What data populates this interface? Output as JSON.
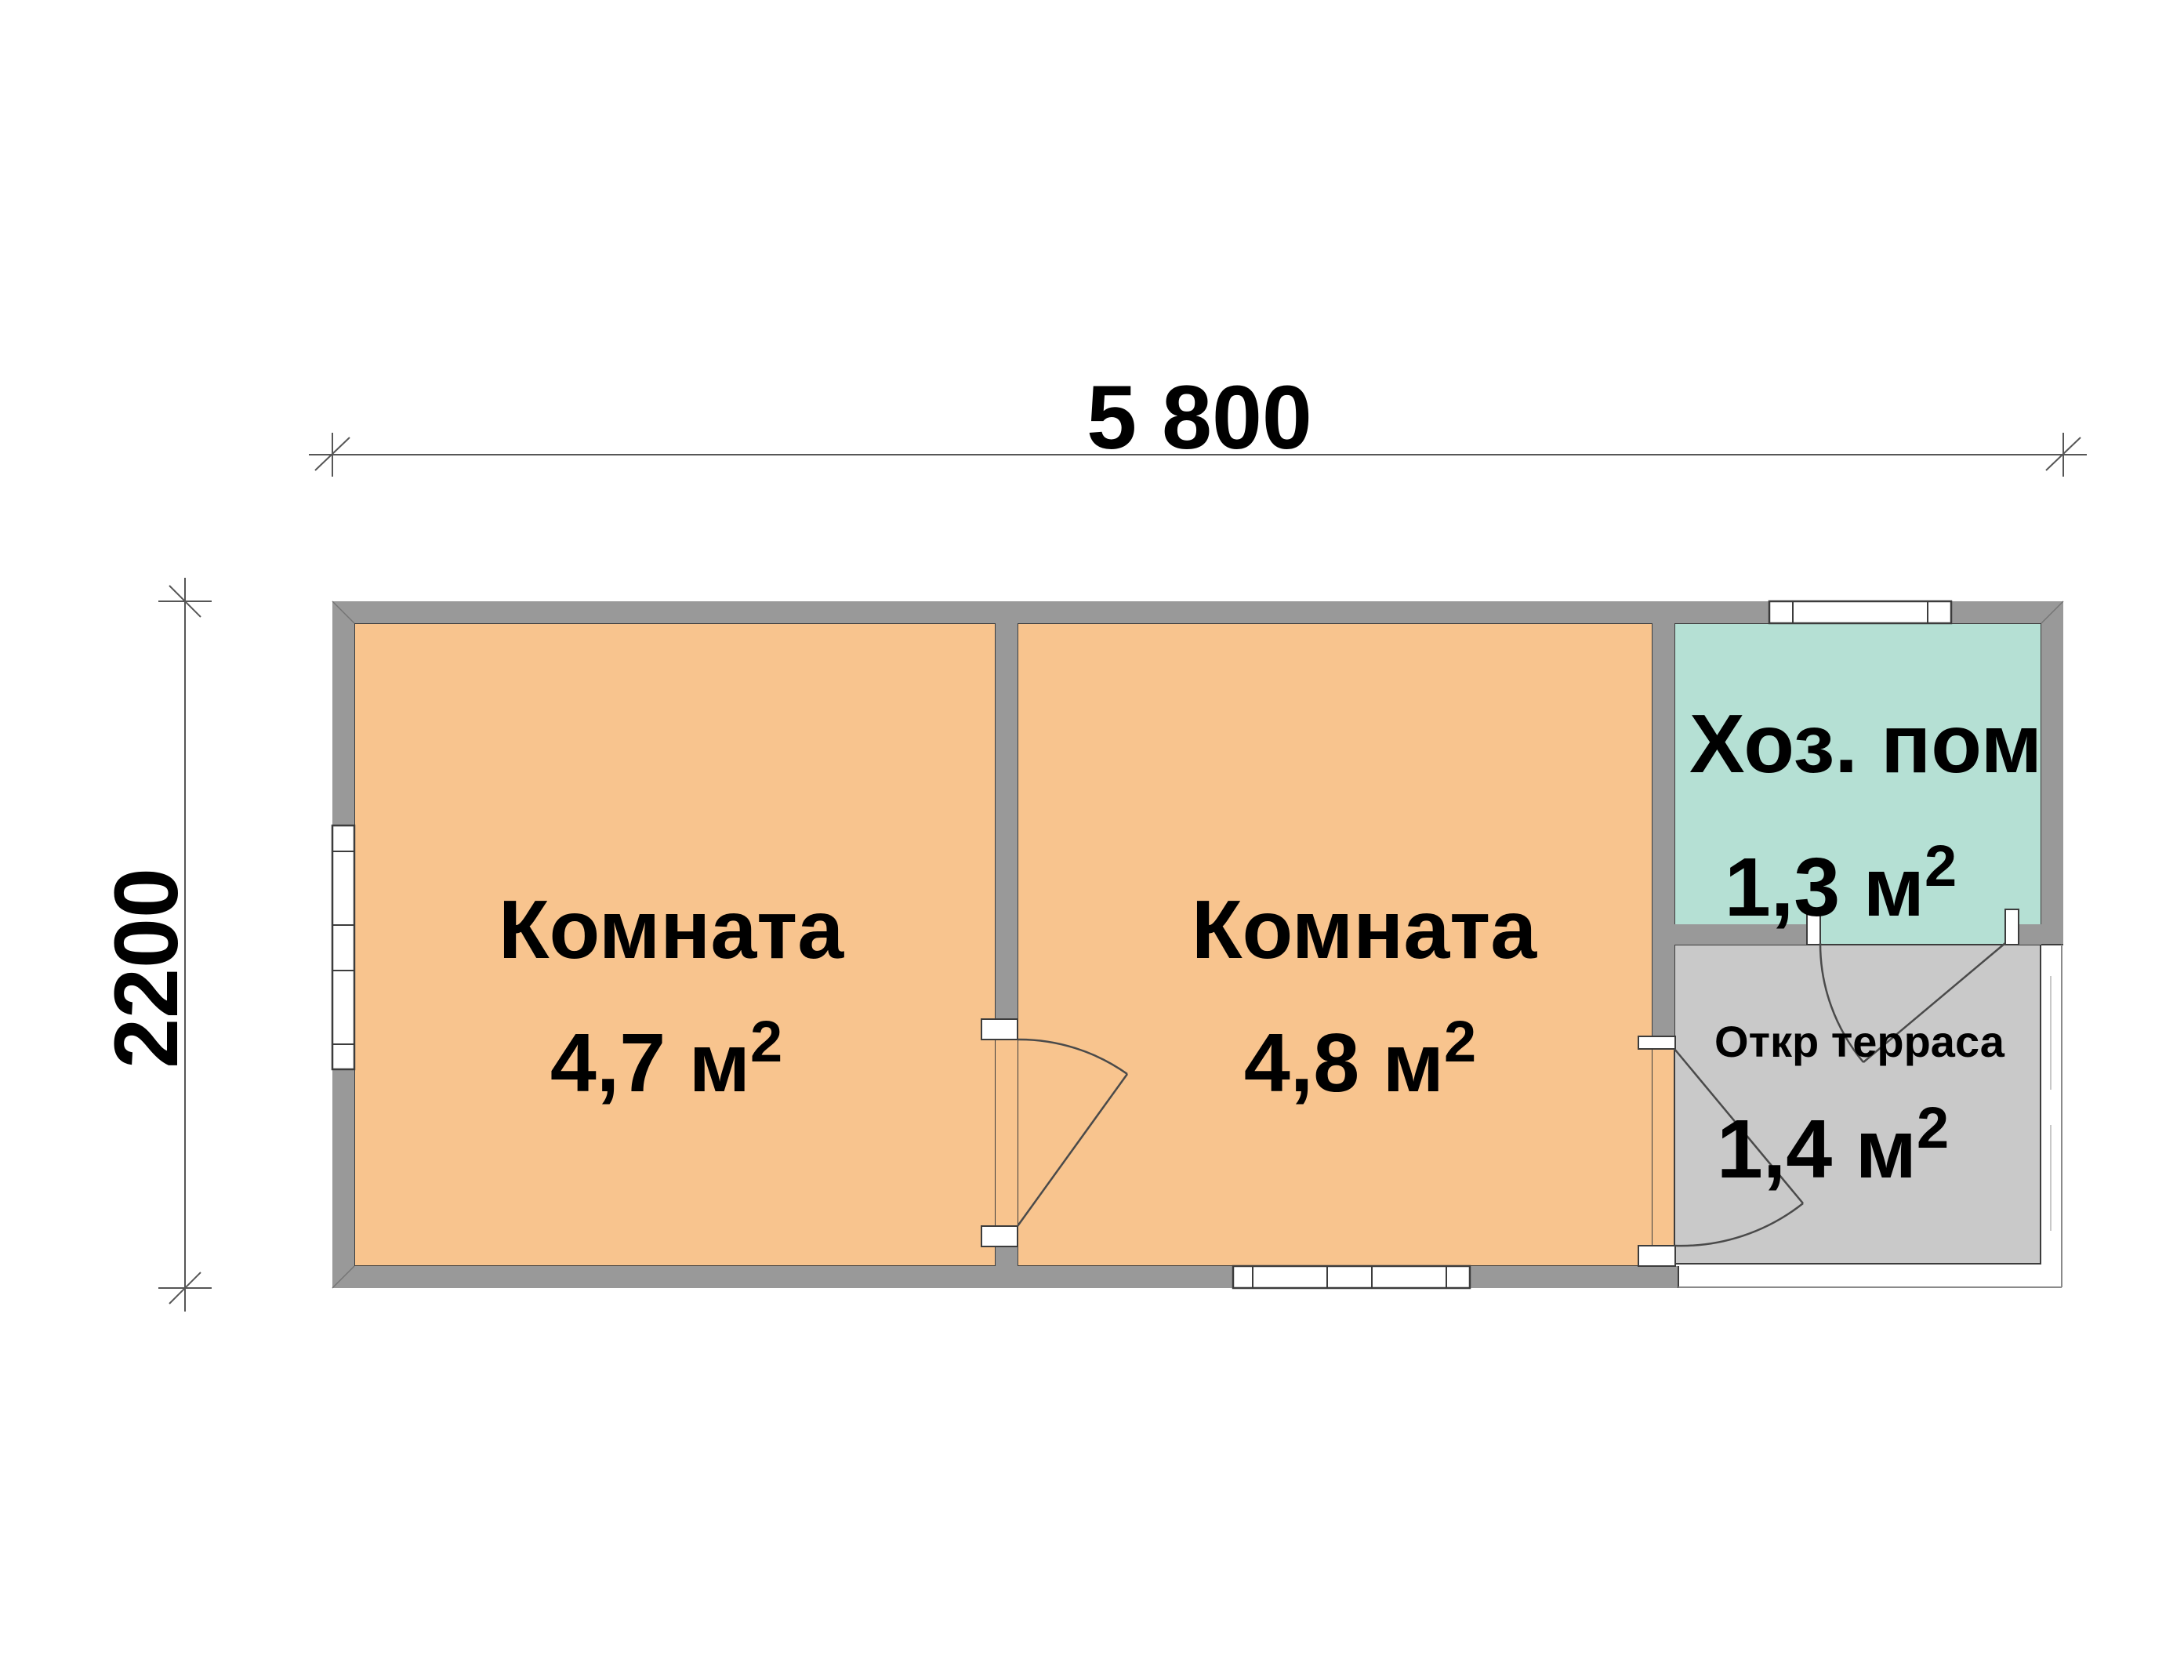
{
  "plan": {
    "dimensions": {
      "width_label": "5 800",
      "height_label": "2200"
    },
    "rooms": [
      {
        "name": "Комната",
        "area": "4,7 м",
        "area_sup": "2"
      },
      {
        "name": "Комната",
        "area": "4,8 м",
        "area_sup": "2"
      },
      {
        "name": "Хоз. пом",
        "area": "1,3 м",
        "area_sup": "2"
      },
      {
        "name": "Откр терраса",
        "area": "1,4 м",
        "area_sup": "2"
      }
    ],
    "colors": {
      "room_fill": "#f8c48e",
      "utility_fill": "#b5e0d4",
      "terrace_fill": "#c9c9c9",
      "wall_fill": "#999999",
      "background": "#ffffff"
    }
  }
}
